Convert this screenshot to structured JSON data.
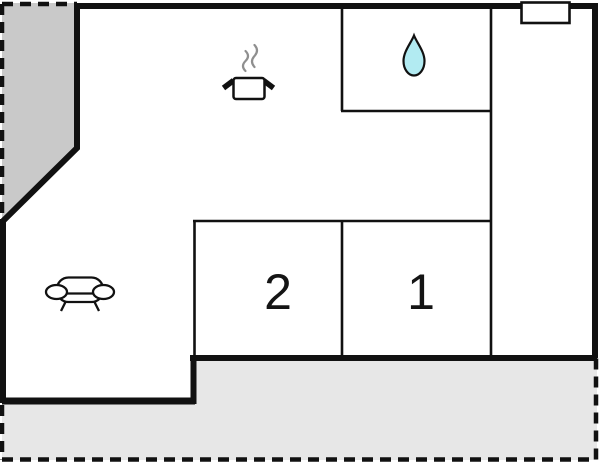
{
  "floorplan": {
    "rooms": [
      {
        "name": "bedroom-2",
        "label": "2"
      },
      {
        "name": "bedroom-1",
        "label": "1"
      }
    ],
    "icons": [
      {
        "name": "cooking-pot-icon",
        "area": "kitchen"
      },
      {
        "name": "water-drop-icon",
        "area": "bathroom"
      },
      {
        "name": "sofa-icon",
        "area": "living-room"
      },
      {
        "name": "window-symbol",
        "area": "exterior-wall"
      }
    ],
    "colors": {
      "wall": "#111111",
      "boundary_dash": "#111111",
      "upper_area_fill": "#c9c9c9",
      "terrace_fill": "#e7e7e7",
      "drop_fill": "#b2ebf2",
      "steam_gray": "#8f8f8f",
      "background": "#ffffff"
    }
  }
}
